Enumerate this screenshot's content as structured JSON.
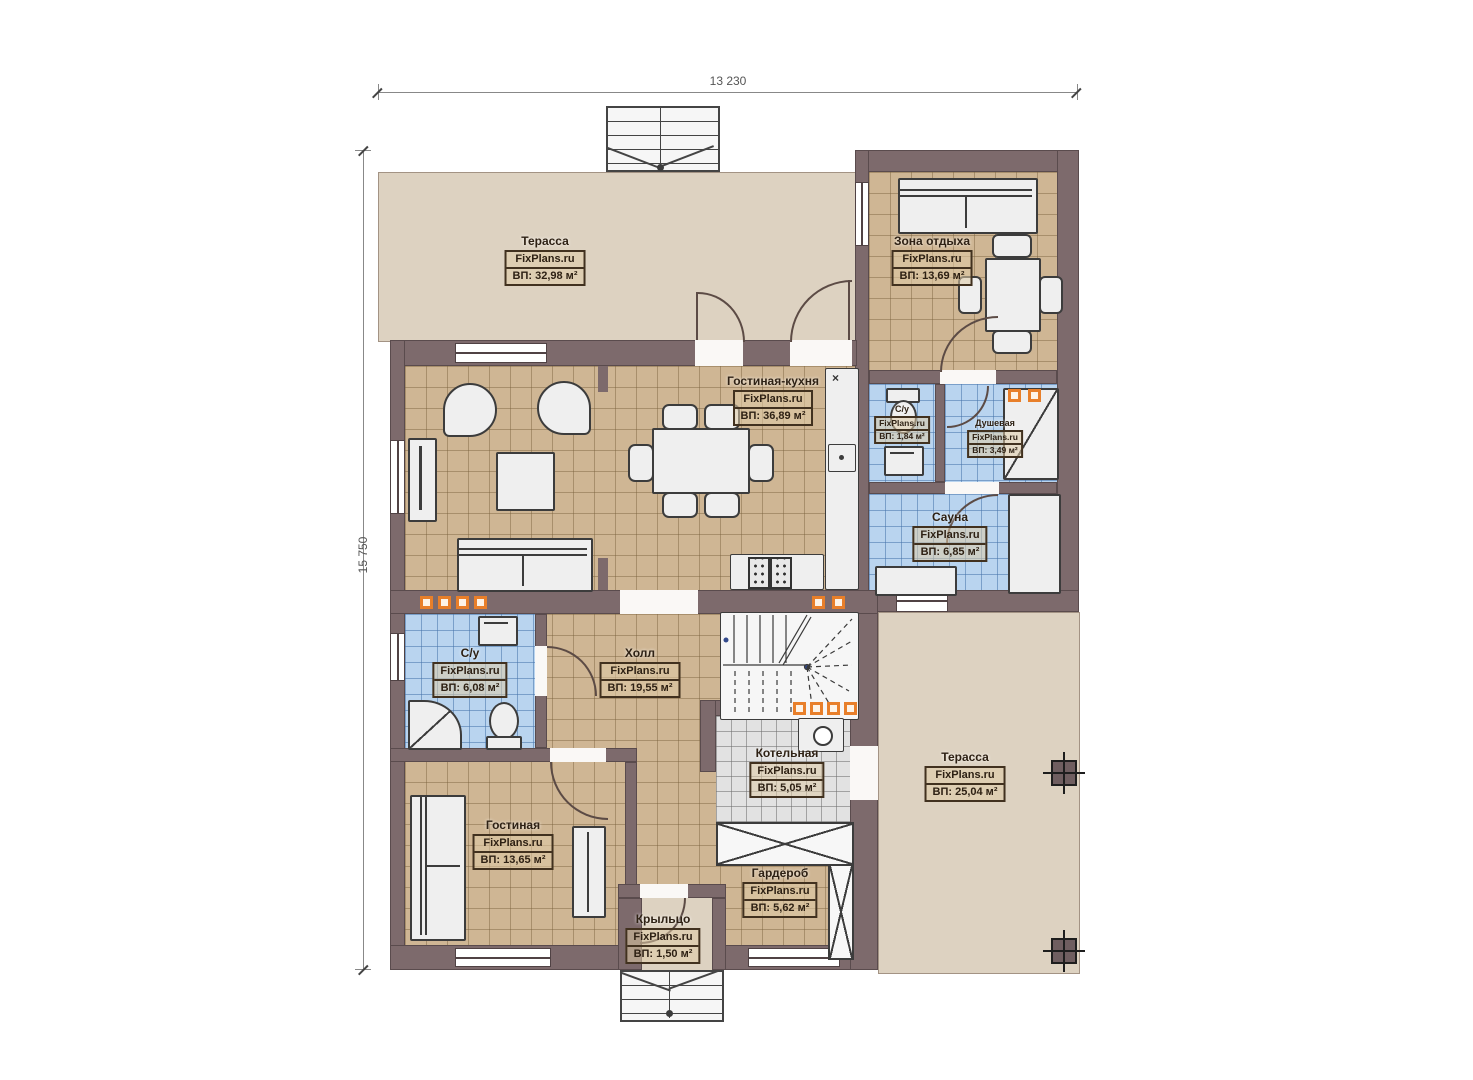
{
  "brand": "FixPlans.ru",
  "dimensions": {
    "top": "13 230",
    "left": "15 750"
  },
  "rooms": [
    {
      "id": "terrace-top",
      "name": "Терасса",
      "area": "ВП: 32,98 м²"
    },
    {
      "id": "lounge",
      "name": "Зона отдыха",
      "area": "ВП: 13,69 м²"
    },
    {
      "id": "living-kitchen",
      "name": "Гостиная-кухня",
      "area": "ВП: 36,89 м²"
    },
    {
      "id": "wc-right",
      "name": "С/у",
      "area": "ВП: 1,84 м²"
    },
    {
      "id": "shower-room",
      "name": "Душевая",
      "area": "ВП: 3,49 м²"
    },
    {
      "id": "sauna",
      "name": "Сауна",
      "area": "ВП: 6,85 м²"
    },
    {
      "id": "wc-left",
      "name": "С/у",
      "area": "ВП: 6,08 м²"
    },
    {
      "id": "hall",
      "name": "Холл",
      "area": "ВП: 19,55 м²"
    },
    {
      "id": "boiler-room",
      "name": "Котельная",
      "area": "ВП: 5,05 м²"
    },
    {
      "id": "living-room",
      "name": "Гостиная",
      "area": "ВП: 13,65 м²"
    },
    {
      "id": "wardrobe",
      "name": "Гардероб",
      "area": "ВП: 5,62 м²"
    },
    {
      "id": "porch",
      "name": "Крыльцо",
      "area": "ВП: 1,50 м²"
    },
    {
      "id": "terrace-right",
      "name": "Терасса",
      "area": "ВП: 25,04 м²"
    }
  ],
  "symbols": {
    "counter_corner": "×"
  },
  "colors": {
    "wall": "#7d6a6c",
    "floor_wood": "#cfb694",
    "floor_wet": "#b9d4ef",
    "floor_tech": "#e2e2e2",
    "terrace": "#ddd2c1",
    "vent_marker": "#e87f2a"
  }
}
